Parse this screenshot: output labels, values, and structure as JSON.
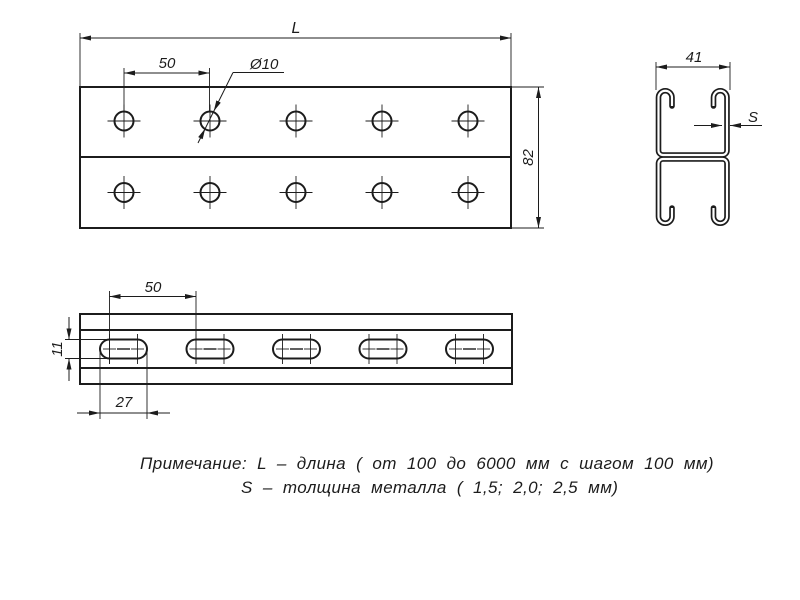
{
  "drawing": {
    "top_view": {
      "dim_length": "L",
      "dim_hole_spacing": "50",
      "dim_hole_diameter": "Ø10",
      "dim_width": "82"
    },
    "cross_section": {
      "dim_width": "41",
      "dim_thickness": "S"
    },
    "side_view": {
      "dim_slot_spacing": "50",
      "dim_slot_height": "11",
      "dim_slot_length": "27"
    },
    "notes": {
      "line1": "Примечание: L – длина ( от 100 до 6000 мм с шагом 100 мм)",
      "line2": "S – толщина металла ( 1,5; 2,0; 2,5 мм)"
    }
  },
  "colors": {
    "line": "#1c1c1c",
    "background": "#ffffff"
  }
}
